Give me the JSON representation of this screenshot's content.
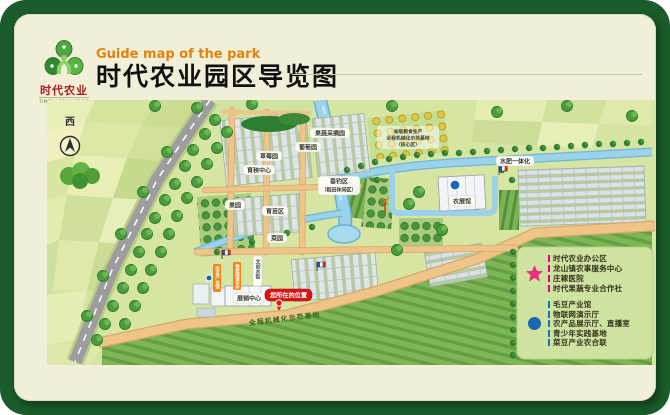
{
  "colors": {
    "frame_green": "#1a5c2a",
    "card_cream": "#f2efd8",
    "title_accent_orange": "#e2820f",
    "brand_red": "#a6201f",
    "badge_red": "#d81414",
    "star_pink": "#e8317e",
    "dot_blue": "#1767b1"
  },
  "header": {
    "logo": {
      "brand_cn": "时代农业",
      "brand_en": "TIMES AGRICULTURE"
    },
    "subtitle_en": "Guide map of the park",
    "title_cn": "时代农业园区导览图"
  },
  "map": {
    "compass_label": "西",
    "labels": {
      "picking_garden": "果蔬采摘园",
      "grape_garden": "葡萄园",
      "strawberry_garden": "草莓园",
      "seedling_center": "育秧中心",
      "orchard": "果园",
      "nursery_area": "育苗区",
      "vegetable_garden": "菜园",
      "fishing_area_line1": "垂钓区",
      "fishing_area_line2": "（稻田休闲区）",
      "agri_exhibition_hall": "农展馆",
      "water_fertilizer": "水肥一体化",
      "exhibition_center": "展销中心",
      "base_note_line1": "省级粮食生产",
      "base_note_line2": "全程机械化示范基地",
      "base_note_line3": "（核心区）",
      "road_text": "全程机械化示范基地",
      "tag_soybean_hall": "毛豆产业馆",
      "tag_iot_hall": "物联网演示厅",
      "tag_cultural_street": "文创水街",
      "you_are_here": "您所在的位置"
    }
  },
  "legend": {
    "star_items": [
      "时代农业办公区",
      "龙山镇农事服务中心",
      "庄稼医院",
      "时代果蔬专业合作社"
    ],
    "dot_items": [
      "毛豆产业馆",
      "物联网演示厅",
      "农产品展示厅、直播室",
      "青少年实践基地",
      "菜豆产业农合联"
    ]
  }
}
